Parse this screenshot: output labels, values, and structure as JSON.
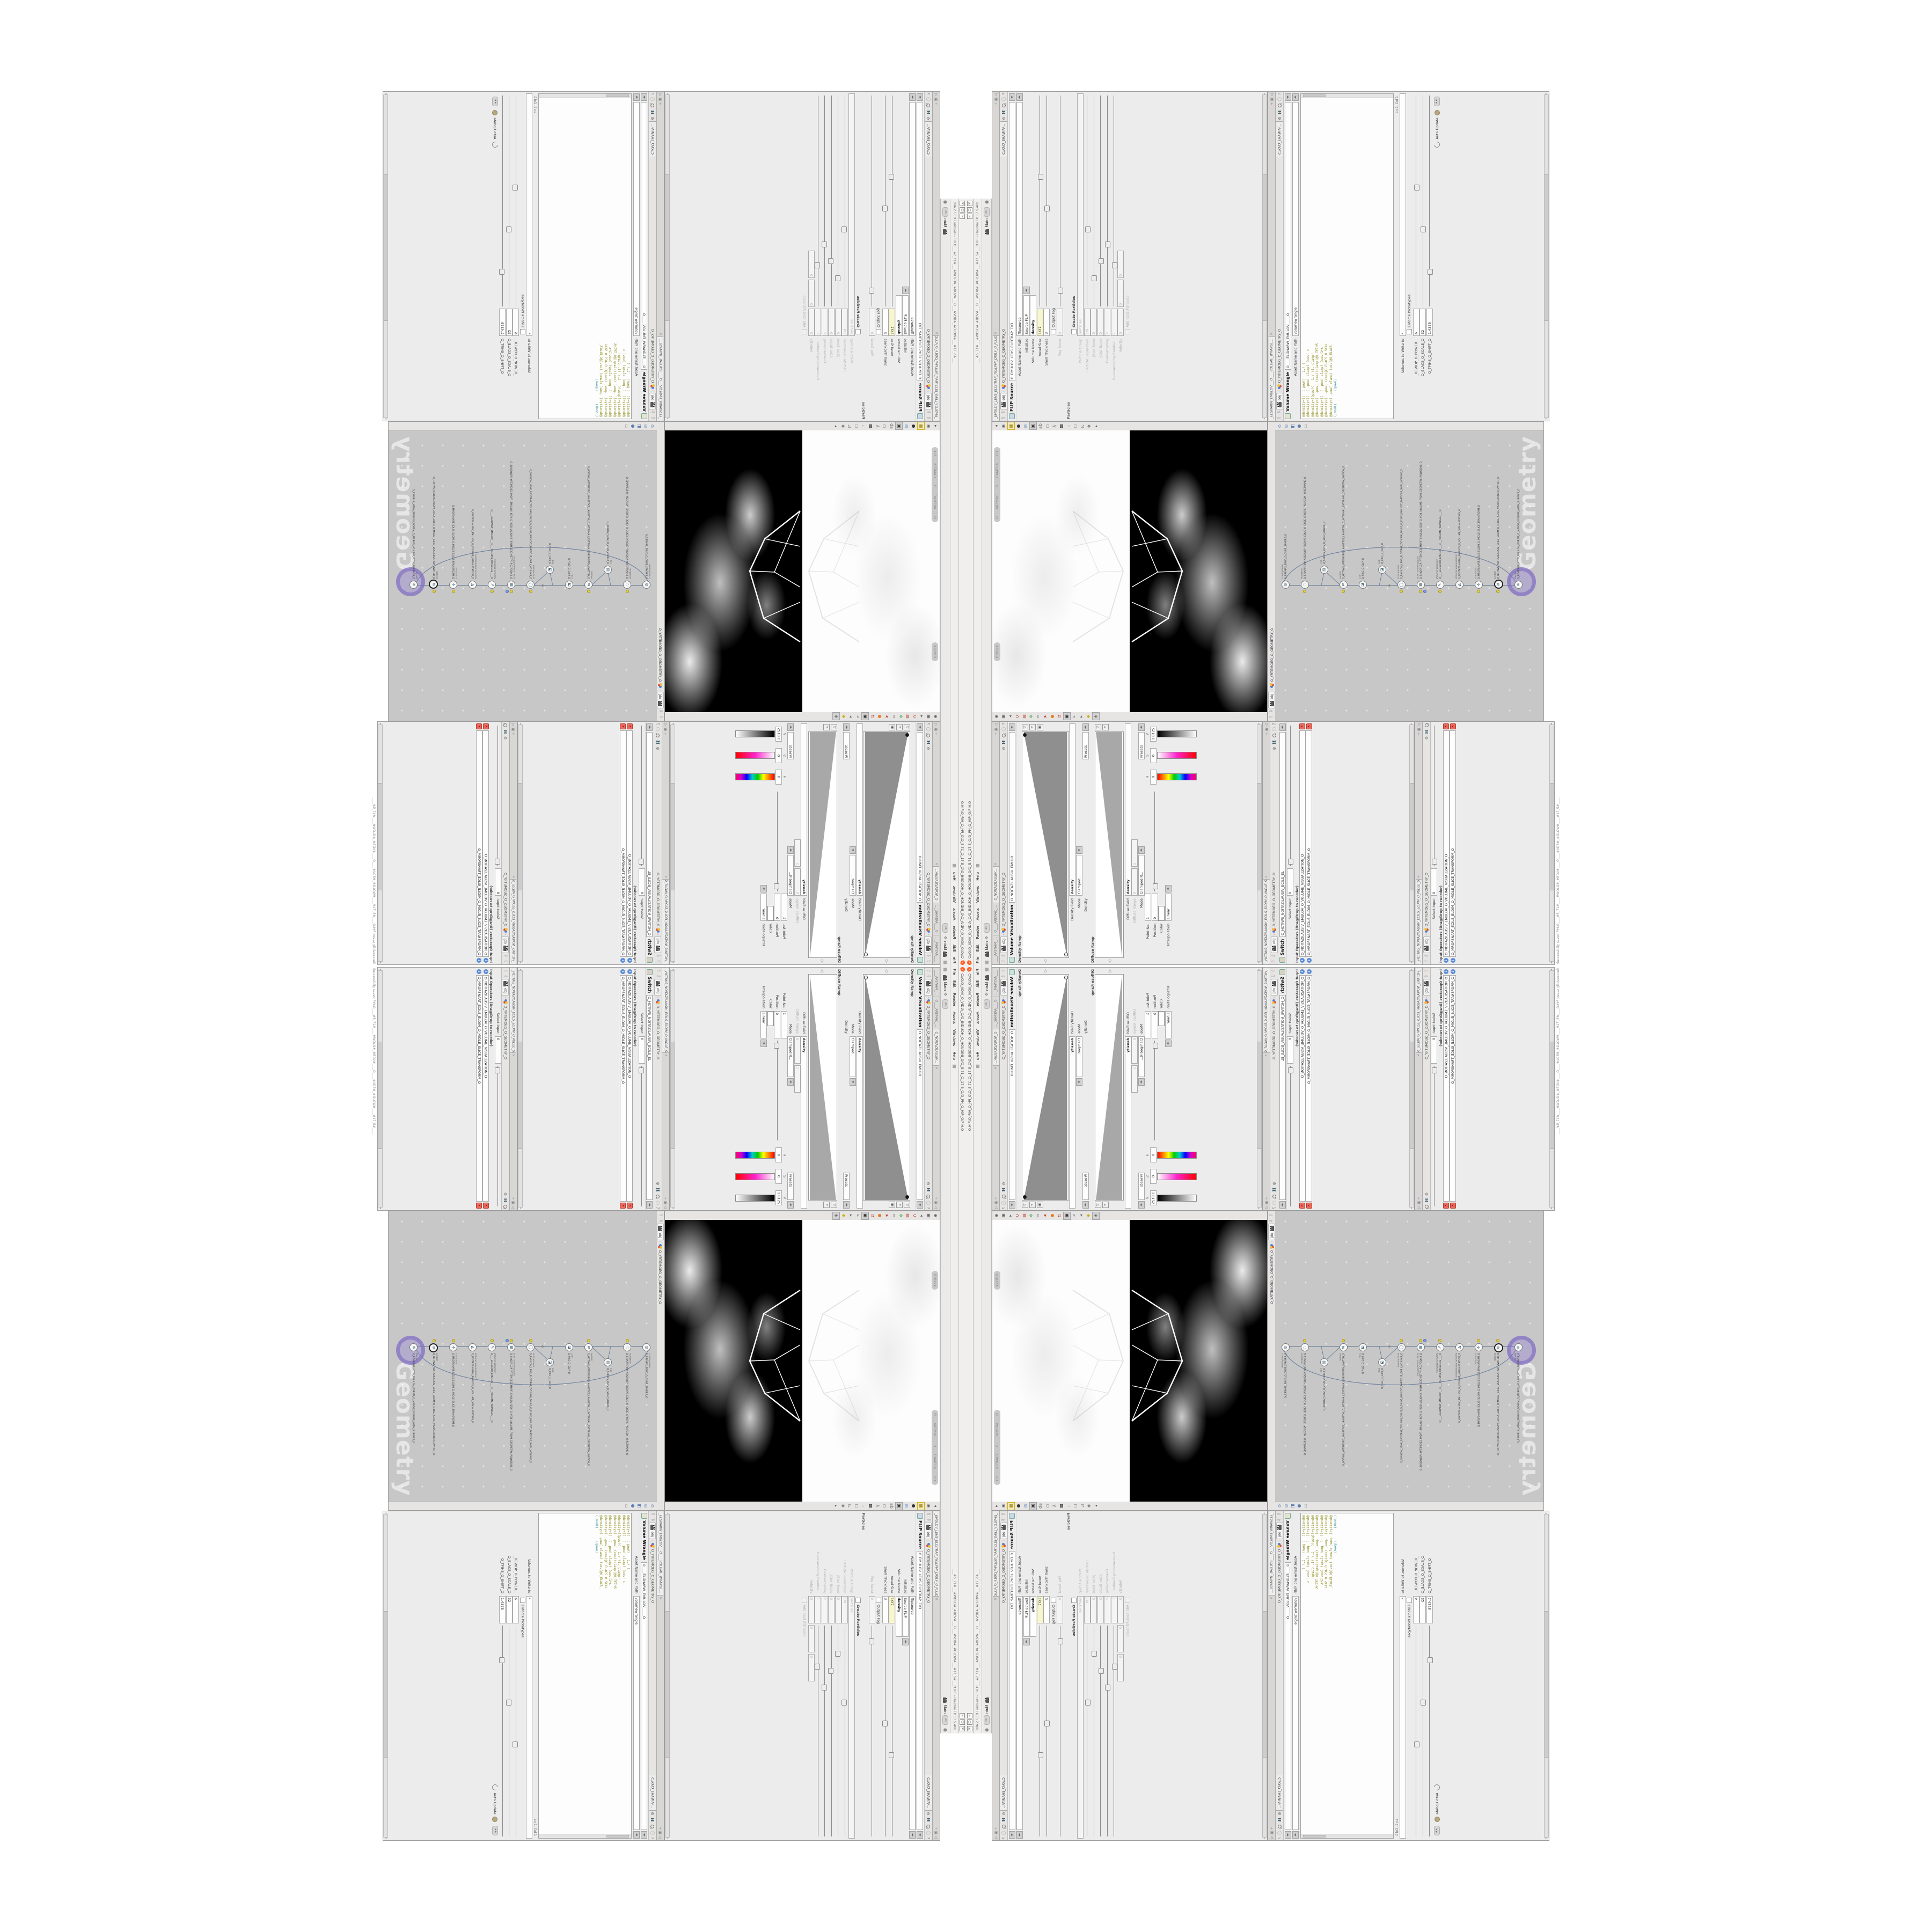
{
  "b": {
    "icons": {
      "gear": "⚙",
      "info": "ⓘ",
      "help": "?",
      "up": "⇧",
      "down": "⇩",
      "left": "◀",
      "right": "▶",
      "tri_l": "◂",
      "tri_r": "▸",
      "close": "✕",
      "pane_corner": "+ ▣ ◁",
      "win_min": "–",
      "win_max": "▢",
      "win_close": "✕",
      "grid": "▦",
      "fourway": "✥",
      "dot": "●"
    },
    "titlebar": {
      "title": "C:/O/O_ADIV_O_VIDIA_O/O_INDUOH_O_HOUDINI_O/O_5.71_O_17.5_O/O_PH_O_HIP_O/PIH.O",
      "title_cont": "___#5_71#___#WOLG#_#BDV#___O___#VDB#_#GLOW#___#17_5#___O.HIP - Houdini FX 17.5.480"
    },
    "menubar": {
      "items": [
        "File",
        "Edit",
        "Render",
        "Assets",
        "Windows",
        "Help"
      ]
    },
    "desktop": {
      "main_label": "Main"
    },
    "crumb": {
      "root": "obj",
      "path": "O_YRTEMOEG_O_GEOMETRY_O",
      "tab": "C:/O/O_ERAWTF..."
    },
    "status": "Successfully saved PIH.O____#5_71#____#WOLG#_#BDV#____O____#VDB#_#GLOW#____#17_5#____",
    "volvis": {
      "tabs": [
        "____ARTNAM_...",
        "O____AREMAC_...",
        "O_NOITAZILAUSIV..."
      ],
      "title": "Volume Visualization",
      "name": "O_NOITAZILAUSIV_EMULO",
      "density_ramp_label": "Density Ramp",
      "density_field_label": "Density Field",
      "density_field_value": "density",
      "mode_label": "Mode",
      "mode_value": "Clamped...",
      "density_label": "Density",
      "presets_label": "Presets",
      "diffuse_ramp_label": "Diffuse Ramp",
      "diffuse_field_label": "Diffuse Field",
      "diffuse_field_value": "density",
      "diffuse_range_label": "Diffuse Range",
      "diffuse_range_min": "0",
      "diffuse_range_max": "1",
      "mode2_value": "Clamped R...",
      "diffuse_label": "Diffuse",
      "point_no_label": "Point No.",
      "point_no_value": "1",
      "position_label": "Position",
      "position_value": "0",
      "color_label": "Color",
      "h_label": "H",
      "h_value": "0",
      "s_label": "S",
      "s_value": "0",
      "v_label": "V",
      "v_value": "1.8125",
      "interp_label": "Interpolation",
      "interp_value": "Linear"
    },
    "switch": {
      "tab": "_HCTIWS_NOITAZILAUSIV_ECILS_ELDIM_O_MIDLE_SLICE_VISUAL...",
      "title": "Switch",
      "name": "O_HCTIWS_NOITAZILAUSIV_ECILS_EL",
      "select_input_label": "Select Input",
      "select_input_value": "0",
      "input_ops_label": "Input Operators (Drag/Drop to reorder)",
      "rows": [
        "O_NOITAZILAUSIV_EMULOV_O_VOLUME_VISUALIZATION_O",
        "O_MROFSNART_ECILS_ELDIM_O_MIDLE_SLICE_TRANSFORM_O"
      ]
    },
    "flip": {
      "tab": "_EMULOV_LEHS_ELCITRAP_TICILPMI_DIULF_O_FLUID_IMPLICIT_PARTI...",
      "title": "FLIP Source",
      "name": "O_EMULOV_LEHS_ELCITRAP_TICI",
      "asset_label": "Asset Name and Path",
      "asset_value": "flipsource",
      "initialize_label": "Initialize",
      "initialize_value": "Source FLIP",
      "volume_name_label": "Volume Name",
      "volume_name_value": "density",
      "voxel_size_label": "Voxel Size",
      "voxel_size_value": "1/27",
      "shell_label": "Shell Thickness",
      "shell_value": "3",
      "output_fog_label": "Output Fog",
      "fog_boost_label": "Fog Boost",
      "fog_boost_value": "0",
      "particles_section": "Particles",
      "create_particles_label": "Create Particles",
      "particle_group_label": "Particle Group",
      "particle_group_value": "particles",
      "particle_sep_label": "Particle Separation",
      "particle_sep_value": "1/9",
      "jitter_seed_label": "Jitter Seed",
      "jitter_seed_value": "0",
      "jitter_scale_label": "Jitter Scale",
      "jitter_scale_value": "0",
      "oversampling_label": "Oversampling",
      "oversampling_value": "2",
      "oversampling_bw_label": "Oversampling Bandwi...",
      "oversampling_bw_value": "1",
      "velocity_label": "Velocity",
      "velocity_x": "0",
      "velocity_y": "0",
      "velocity_z": "0",
      "add_rest_label": "Add Rest Attribute"
    },
    "wrangle": {
      "tab": "_ELGNARW_EMULOV___O____VOLUME_WRANGL...",
      "title": "Volume Wrangle",
      "name": "O____ELGNARW_EMULOV_____O",
      "asset_label": "Asset Name and Path",
      "asset_value": "volumewrangle",
      "code": [
        "@density=((  ( pow((   1./ (",
        "@density=((  ( -pow( clamp( (cos( c",
        "@density=((pow((   1./ (1.-clamp(",
        "@density=(  -pow( (cos((clamp(@O_TFIHS",
        "@density=((  ( -pow( clamp( (cos(1*$",
        "@density=(  -pow( (cos(@O_ELACS_O_SCAL",
        "@density=( -pow( clamp( (cos(@O_ELACS_",
        "((mod((      ))pow(("
      ],
      "volumes_label": "Volumes to Write to",
      "volumes_value": "*",
      "enforce_label": "Enforce Prototypes",
      "params": [
        {
          "label": "_REWOP_O_POWER...",
          "value": "6"
        },
        {
          "label": "O_ELACS_O_SCALE_O",
          "value": "32"
        },
        {
          "label": "O_TFIHS_O_SHIFT_O",
          "value": "1.4375"
        }
      ],
      "cursor_pos": "Ln 1, Col 1",
      "auto_update": "Auto Update"
    },
    "viewport": {
      "ortho_label": "Ortho ▾",
      "camera_label": "O____AREMAC____O____CAMERA____O ▾",
      "tools_left": [
        "◉",
        "▣",
        "◂",
        "∪",
        "▤",
        "✲",
        "✂",
        "➤",
        "●",
        "◔",
        "▣",
        "➢",
        "▸",
        "◆",
        "◈"
      ],
      "tools_right": [
        "◂",
        "◉",
        "▦",
        "●",
        "◎",
        "▣",
        "ab",
        "○",
        "⅄",
        "▩",
        "◞",
        "◻",
        "◺",
        "❖",
        "▸"
      ]
    },
    "network": {
      "path": "O_YRTEMOEG_O_GEOMETRY_O",
      "watermark": "Geometry",
      "tools": [
        "⊙",
        "◎",
        "◧",
        "●",
        "▭"
      ],
      "nodes": [
        {
          "type": "CubeSphere",
          "label": "O_EREHPS_EBUC_O_CUBE_SPHERE_O",
          "g": "◍"
        },
        {
          "type": "PolyWire",
          "label": "O_EMARFERIW_NOGYLOP_EREHPS_EBUC_O_CUBE_SPHERE_POLYGON_WIREFRAME_O",
          "g": "◌"
        },
        {
          "type": "File",
          "label": "O_SDILOS_PETS_O_STEP_SOLIDS_O",
          "g": "▤"
        },
        {
          "type": "Switch",
          "label": "O_HCTIWS_YRTEMOEG_LANRETXE_LANRETNI_O_INTERNAL_EXTERNAL_GEOMETRY_SWITCH_O",
          "g": "⇄"
        },
        {
          "type": "Clip",
          "label": "O_PILC_O_CLIP_O",
          "g": "◪"
        },
        {
          "type": "Clip",
          "label": "O_PILC_O_CLIP_O",
          "g": "◪"
        },
        {
          "type": "FLIP Source",
          "label": "O_EMULOV_LEHS_ELCITRAP_TICILPMI_DIULF_O_FLUID_IMPLICIT_PARTICLE_SHEL_VOLUME_O",
          "g": "◯"
        },
        {
          "type": "VDB from Polygons",
          "label": "O_SNOGYLOP_YRTEMOEG_MORF_EMULOV_BDV_O_VDB_VOLUME_FROM_GEOMETRY_POLYGONS_O",
          "g": "▦"
        },
        {
          "type": "Volume Wrangle",
          "label": "O____ELGNARW_EMULOV___O___VOLUME_WRANGLE____O",
          "g": "✎"
        },
        {
          "type": "Volume Visualization",
          "label": "O_NOITAZILAUSIV_EMULOV_O_VOLUME_VISUALIZATION_O",
          "g": "◭"
        },
        {
          "type": "Transform",
          "label": "O_MROFSNART_ECILS_ELDIM_O_MIDLE_SLICE_TRANSFORM_O",
          "g": "✛"
        },
        {
          "type": "Switch",
          "label": "O_HCTIWS_NOITAZILAUSIV_ECILS_ELDIM_O_MIDLE_SLICE_VISUALIZATION_SWITCH_O",
          "g": "⇄"
        },
        {
          "type": "Merge",
          "label": "O_ECAFRUS_HTIW_EMULOV_EGREM_O_MERGE_VOLUME_WITH_SURFACE_O",
          "g": "⊕"
        }
      ]
    }
  }
}
